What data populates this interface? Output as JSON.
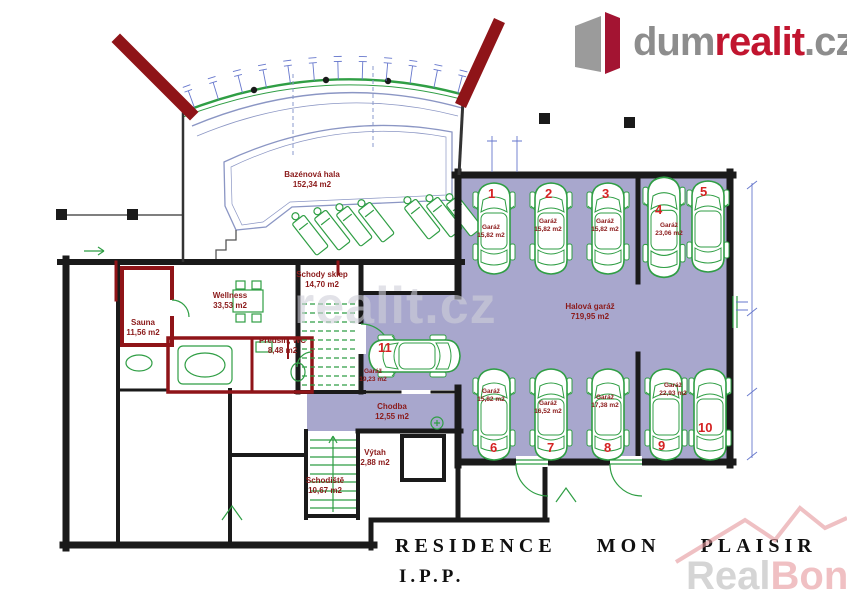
{
  "logo": {
    "brand_gray": "dum",
    "brand_red": "realit",
    "brand_tld": ".cz"
  },
  "title": {
    "line1": "RESIDENCE MON PLAISIR",
    "line2": "I.P.P."
  },
  "watermarks": {
    "center": "realit.cz",
    "bottom_real": "Real",
    "bottom_bonus": "Bonus",
    "bottom_tld": ".cz"
  },
  "plan": {
    "rooms": [
      {
        "name": "Bazénová hala",
        "area": "152,34 m2"
      },
      {
        "name": "Wellness",
        "area": "33,53 m2"
      },
      {
        "name": "Sauna",
        "area": "11,56 m2"
      },
      {
        "name": "Předsíň, WC",
        "area": "8,48 m2"
      },
      {
        "name": "Schody sklep",
        "area": "14,70 m2"
      },
      {
        "name": "Chodba",
        "area": "12,55 m2"
      },
      {
        "name": "Výtah",
        "area": "2,88 m2"
      },
      {
        "name": "Schodiště",
        "area": "10,67 m2"
      },
      {
        "name": "Halová garáž",
        "area": "719,95 m2"
      }
    ],
    "parking": [
      {
        "num": "1",
        "label": "Garáž",
        "area": "15,82 m2"
      },
      {
        "num": "2",
        "label": "Garáž",
        "area": "15,82 m2"
      },
      {
        "num": "3",
        "label": "Garáž",
        "area": "15,82 m2"
      },
      {
        "num": "4",
        "label": "Garáž",
        "area": "23,06 m2"
      },
      {
        "num": "5",
        "label": "",
        "area": ""
      },
      {
        "num": "6",
        "label": "Garáž",
        "area": "15,82 m2"
      },
      {
        "num": "7",
        "label": "Garáž",
        "area": "16,52 m2"
      },
      {
        "num": "8",
        "label": "Garáž",
        "area": "17,38 m2"
      },
      {
        "num": "9",
        "label": "Garáž",
        "area": "22,93 m2"
      },
      {
        "num": "10",
        "label": "",
        "area": ""
      },
      {
        "num": "11",
        "label": "Garáž",
        "area": "19,23 m2"
      }
    ]
  },
  "colors": {
    "garage_fill": "#a8a7cd",
    "wall": "#1a1a1a",
    "red_wall": "#8f1418",
    "green": "#2f9e44",
    "label": "#8b1a1a",
    "number": "#d42222",
    "dim": "#6677cc",
    "logo_red": "#c1152f",
    "logo_gray": "#8d8d8d"
  }
}
